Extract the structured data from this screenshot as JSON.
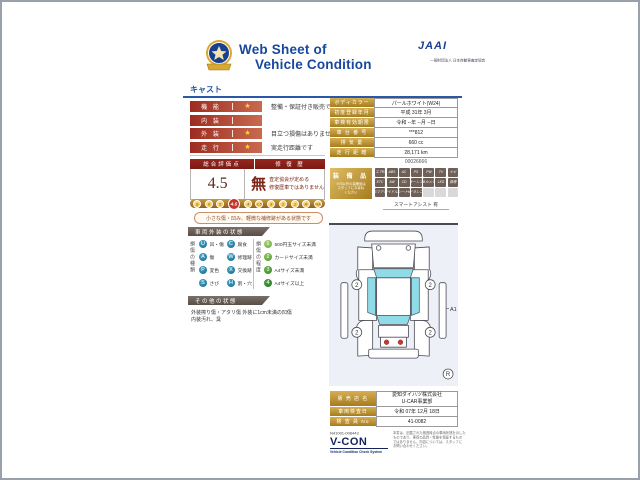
{
  "colors": {
    "accent_blue": "#17479e",
    "maroon": "#8a211d",
    "red_pill": "#9d2c20",
    "gold": "#b8891f",
    "teal": "#16688c",
    "green": "#3f9e37",
    "window_cyan": "#8fdbe8",
    "taillight_red": "#c23b2e"
  },
  "header": {
    "title_line1": "Web Sheet of",
    "title_line2": "Vehicle Condition",
    "jaai_logo": "JAAI",
    "jaai_subtitle": "一般財団法人 日本自動車査定協会",
    "model_name": "キャスト"
  },
  "summary_rows": [
    {
      "label": "機 能",
      "star": "★",
      "desc": "整備・保証付き販売です"
    },
    {
      "label": "内 装",
      "star": "",
      "desc": ""
    },
    {
      "label": "外 装",
      "star": "★",
      "desc": "目立つ損傷はありません"
    },
    {
      "label": "走 行",
      "star": "★",
      "desc": "実走行距離です"
    }
  ],
  "rating": {
    "score_header": "総合評価点",
    "repair_header": "修 復 歴",
    "score": "4.5",
    "repair_value": "無",
    "repair_note_line1": "査定協会が定める",
    "repair_note_line2": "修復歴車ではありません",
    "scale": [
      "S",
      "6",
      "5",
      "4.5",
      "4",
      "3.5",
      "3",
      "2",
      "1",
      "R",
      "RA"
    ],
    "scale_active": "4.5",
    "note": "小さな傷・凹み、軽微な補修跡がある状態です"
  },
  "exterior": {
    "section_title": "車両外装の状態",
    "damage_type_header": "損傷の種類",
    "damage_types": [
      {
        "code": "U",
        "label": "凹・傷"
      },
      {
        "code": "A",
        "label": "傷"
      },
      {
        "code": "P",
        "label": "変色"
      },
      {
        "code": "S",
        "label": "さび"
      },
      {
        "code": "C",
        "label": "腐食"
      },
      {
        "code": "W",
        "label": "修理跡"
      },
      {
        "code": "X",
        "label": "交換跡"
      },
      {
        "code": "H",
        "label": "割・穴"
      }
    ],
    "damage_degree_header": "損傷の程度",
    "damage_degrees": [
      {
        "code": "1",
        "label": "500円玉サイズ未満"
      },
      {
        "code": "2",
        "label": "カードサイズ未満"
      },
      {
        "code": "3",
        "label": "A4サイズ未満"
      },
      {
        "code": "4",
        "label": "A4サイズ以上"
      }
    ]
  },
  "other_condition": {
    "section_title": "その他の状態",
    "line1": "外装擦り傷・アタリ傷 外装に1cm未満の凹傷",
    "line2": "内装汚れ、臭"
  },
  "vehicle_info": {
    "rows": [
      {
        "label": "ボディカラー",
        "value": "パールホワイト(W24)"
      },
      {
        "label": "初度登録年月",
        "value": "平成 31年 3月"
      },
      {
        "label": "車検有効期限",
        "value": "令和 --年 --月 --日"
      },
      {
        "label": "車 台 番 号",
        "value": "***812"
      },
      {
        "label": "排 気 量",
        "value": "660 cc"
      },
      {
        "label": "走 行 距 離",
        "value": "28,171 km"
      }
    ],
    "serial": "00026666"
  },
  "equipment": {
    "title": "装 備 品",
    "note_lines": [
      "※印以外の装備品は",
      "スタッフにお尋ね",
      "ください"
    ],
    "badges": [
      "エアB",
      "ABS",
      "AC",
      "PS",
      "PW",
      "TV",
      "ナビ",
      "ETC",
      "AW",
      "CD",
      "キーレス",
      "Bカメラ",
      "LED",
      "禁煙",
      "スマアシ",
      "アイドルS",
      "シートH",
      "ドラレコ",
      "",
      "",
      ""
    ],
    "footer": "スマートアシスト 有"
  },
  "diagram": {
    "wheel_marks": [
      "2",
      "2",
      "2",
      "2"
    ],
    "damage_marker": "A1",
    "corner_mark": "R"
  },
  "dealer": {
    "rows": [
      {
        "label": "販 売 店 名",
        "value_line1": "愛知ダイハツ株式会社",
        "value_line2": "U-CAR事業部"
      },
      {
        "label": "車両検査日",
        "value": "令和 07年 12月 18日"
      },
      {
        "label": "検 査 員 No",
        "value": "41-0082"
      }
    ],
    "doc_number": "N41001-008443",
    "vcon_logo": "V-CON",
    "vcon_tagline": "Vehicle Condition Check System",
    "disclaimer_lines": [
      "本書は、記載された検査時点の車両状態を示した",
      "ものであり、車両の品質・性能を保証するもの",
      "ではありません。内容については、スタッフに",
      "お問い合わせください。"
    ]
  }
}
